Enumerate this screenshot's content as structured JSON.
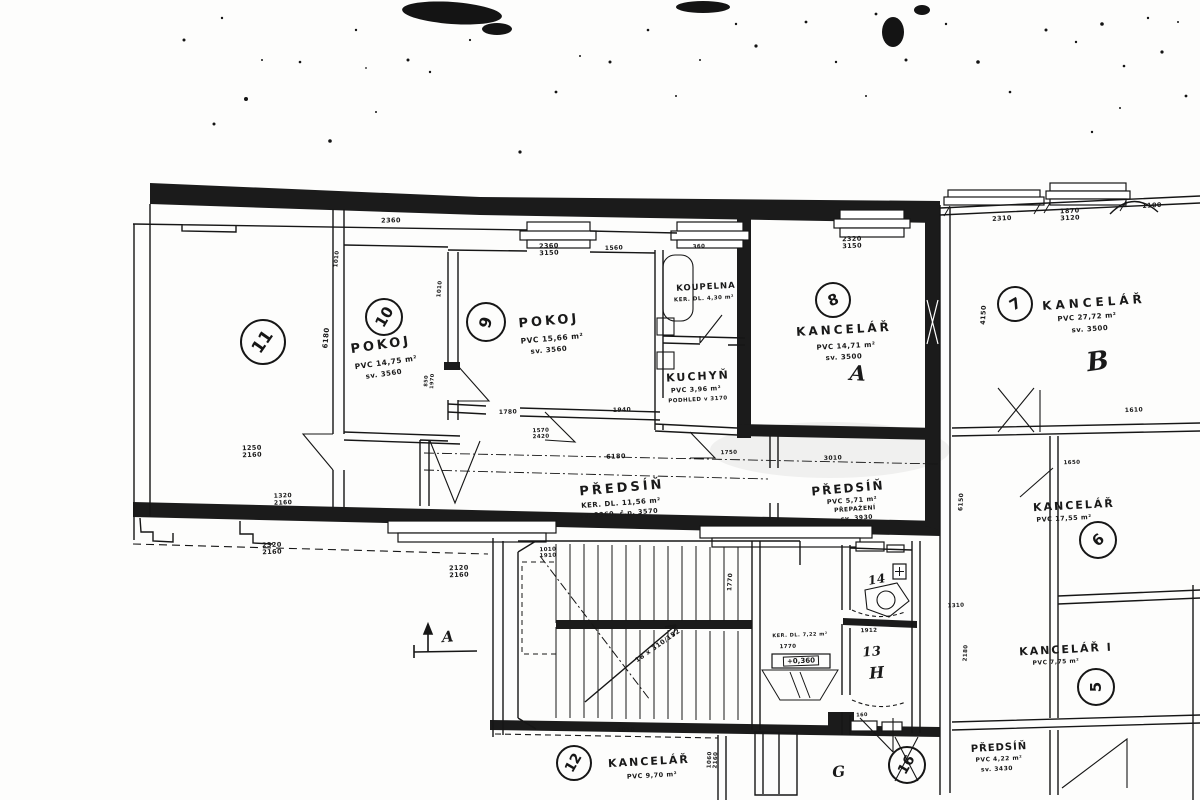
{
  "rooms": {
    "r11": {
      "number": "11"
    },
    "r10": {
      "number": "10",
      "name": "POKOJ",
      "line1": "PVC 14,75 m²",
      "line2": "sv. 3560"
    },
    "r9": {
      "number": "9",
      "name": "POKOJ",
      "line1": "PVC 15,66 m²",
      "line2": "sv. 3560"
    },
    "koupelna": {
      "name": "KOUPELNA",
      "line1": "KER. DL. 4,30 m²"
    },
    "kuchyn": {
      "name": "KUCHYŇ",
      "line1": "PVC 3,96 m²",
      "line2": "PODHLED v 3170"
    },
    "r8": {
      "number": "8",
      "name": "KANCELÁŘ",
      "line1": "PVC 14,71 m²",
      "line2": "sv. 3500",
      "letter": "A"
    },
    "r7": {
      "number": "7",
      "name": "KANCELÁŘ",
      "line1": "PVC 27,72 m²",
      "line2": "sv. 3500",
      "letter": "B"
    },
    "r6": {
      "number": "6",
      "name": "KANCELÁŘ",
      "line1": "PVC 17,55 m²"
    },
    "r5": {
      "number": "5",
      "name": "KANCELÁŘ I",
      "line1": "PVC 7,75 m²"
    },
    "predsin1": {
      "name": "PŘEDSÍŇ",
      "line1": "KER. DL. 11,56 m²",
      "line2": "sv. 3360, č.p. 3570"
    },
    "predsin2": {
      "name": "PŘEDSÍŇ",
      "line1": "PVC 5,71 m²",
      "line2": "PŘEPAŽENÍ",
      "line3": "sv. 3930"
    },
    "predsin3": {
      "name": "PŘEDSÍŇ",
      "line1": "PVC 4,22 m²",
      "line2": "sv. 3430"
    },
    "r12": {
      "number": "12",
      "name": "KANCELÁŘ",
      "line1": "PVC 9,70 m²"
    },
    "r16": {
      "number": "16",
      "letter": "G"
    },
    "r13": {
      "number": "13",
      "letter": "H"
    },
    "r14": {
      "number": "14"
    }
  },
  "stairs": {
    "spec": "18 x 310/152",
    "landing": "KER. DL. 7,22 m²",
    "elevation": "+0,360"
  },
  "section_mark": {
    "label": "A"
  },
  "dims": [
    "2360",
    "2360\n3150",
    "1560",
    "360",
    "2320\n3150",
    "2310",
    "1870\n3120",
    "1100",
    "6180",
    "1010",
    "1010",
    "1250\n2160",
    "1320\n2160",
    "2320\n2160",
    "2120\n2160",
    "1780",
    "1940",
    "1570\n2420",
    "6180",
    "1750",
    "3010",
    "4150",
    "1610",
    "1310",
    "2180",
    "1770",
    "1010\n1910",
    "1912",
    "1770",
    "4010",
    "1060\n2160",
    "6150",
    "850\n1970",
    "1650",
    "160"
  ]
}
